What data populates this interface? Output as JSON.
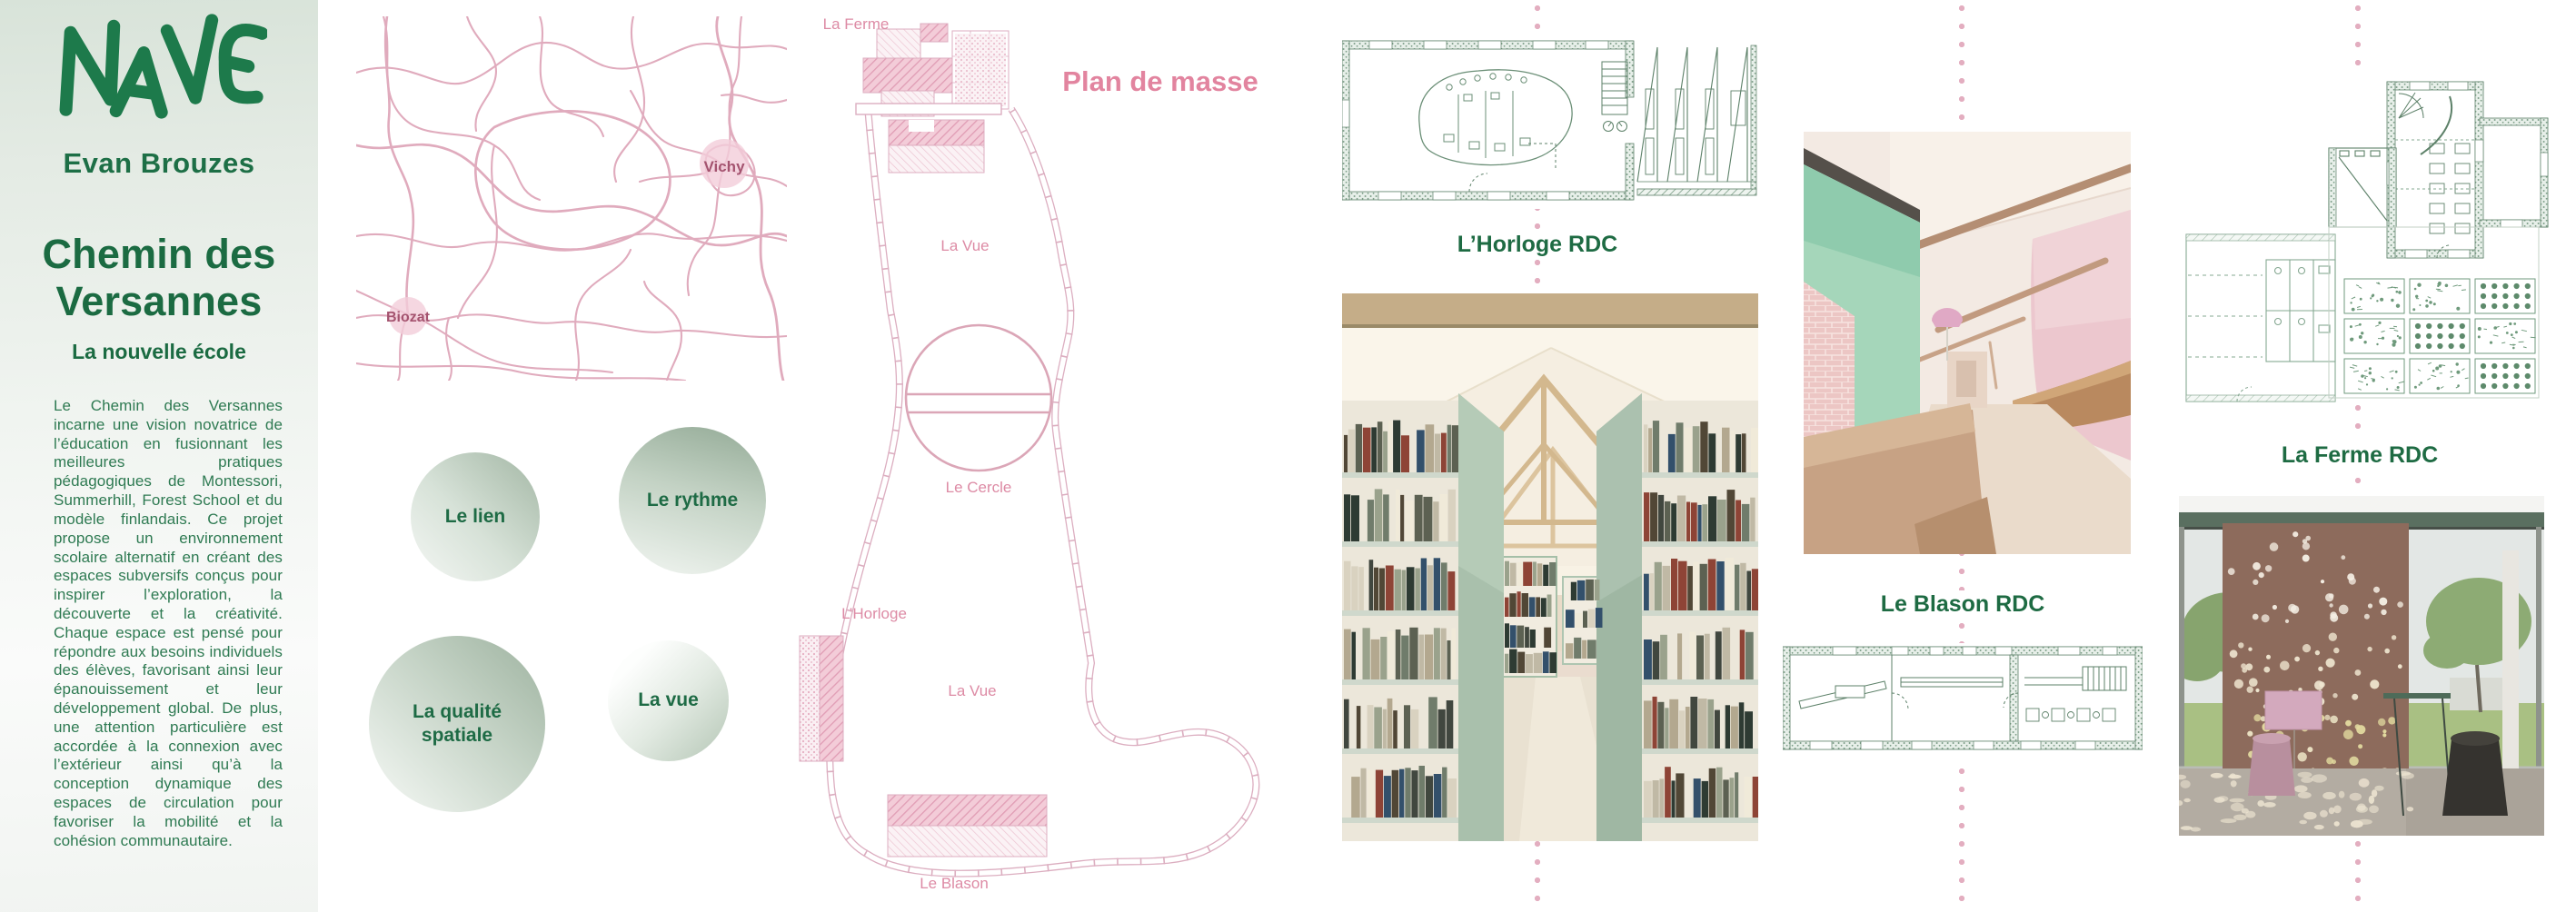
{
  "board": {
    "brand": "NAVE",
    "author": "Evan Brouzes",
    "project_title": "Chemin des Versannes",
    "project_subtitle": "La nouvelle école",
    "description": "Le Chemin des Versannes incarne une vision novatrice de l’éducation en fusionnant les meilleures pratiques pédagogiques de Montessori, Summerhill, Forest School et du modèle finlandais. Ce projet propose un environnement scolaire alternatif en créant des espaces subversifs conçus pour inspirer l’exploration, la découverte et la créativité. Chaque espace est pensé pour répondre aux besoins individuels des élèves, favorisant ainsi leur épanouissement et leur développement global. De plus, une attention particulière est accordée à la connexion avec l’extérieur ainsi qu’à la conception dynamique des espaces de circulation pour favoriser la mobilité et la cohésion communautaire."
  },
  "map": {
    "city_label": "Vichy",
    "town_label": "Biozat"
  },
  "site_plan": {
    "title": "Plan de masse",
    "labels": {
      "ferme": "La Ferme",
      "vue_top": "La Vue",
      "cercle": "Le Cercle",
      "horloge": "L’Horloge",
      "vue_bottom": "La Vue",
      "blason": "Le Blason"
    }
  },
  "concept_circles": {
    "lien": "Le lien",
    "rythme": "Le rythme",
    "qualite": "La qualité spatiale",
    "vue": "La vue"
  },
  "floor_plans": {
    "horloge_label": "L’Horloge RDC",
    "blason_label": "Le Blason RDC",
    "ferme_label": "La Ferme RDC"
  },
  "colors": {
    "brand_green": "#1d7a4b",
    "text_green": "#2e7a52",
    "plan_pink": "#dcaec0",
    "label_pink": "#dd8ba5",
    "map_road_pink": "#e0abbd",
    "map_city_text": "#a4536f",
    "plan_green": "#5d8169",
    "dot_pink": "#e3aec0"
  }
}
